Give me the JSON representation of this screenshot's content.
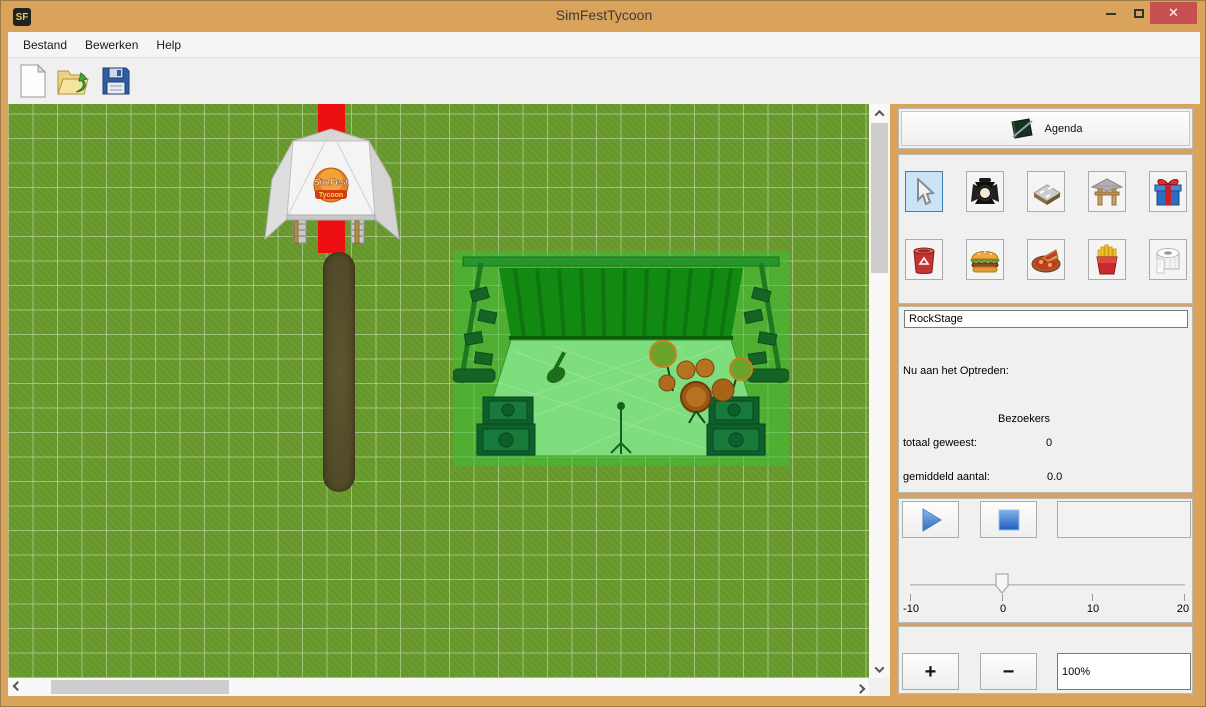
{
  "window": {
    "logo_text": "SF",
    "title": "SimFestTycoon",
    "close_glyph": "✕"
  },
  "menu": {
    "bestand": "Bestand",
    "bewerken": "Bewerken",
    "help": "Help"
  },
  "toolbar": {
    "buttons": [
      "new-file-icon",
      "open-folder-icon",
      "save-floppy-icon"
    ]
  },
  "map": {
    "objects": [
      "entrance-tent",
      "red-carpet",
      "dirt-path",
      "rock-stage-preview"
    ]
  },
  "panel": {
    "agenda_label": "Agenda",
    "tools": [
      {
        "name": "select-tool",
        "icon": "cursor-arrow-icon",
        "selected": true
      },
      {
        "name": "spotlight-tool",
        "icon": "spotlight-icon",
        "selected": false
      },
      {
        "name": "road-tool",
        "icon": "road-tile-icon",
        "selected": false
      },
      {
        "name": "gate-tool",
        "icon": "entrance-gate-icon",
        "selected": false
      },
      {
        "name": "present-tool",
        "icon": "gift-box-icon",
        "selected": false
      },
      {
        "name": "trash-tool",
        "icon": "trash-can-icon",
        "selected": false
      },
      {
        "name": "burger-tool",
        "icon": "burger-icon",
        "selected": false
      },
      {
        "name": "pizza-tool",
        "icon": "pizza-icon",
        "selected": false
      },
      {
        "name": "fries-tool",
        "icon": "fries-icon",
        "selected": false
      },
      {
        "name": "toilet-paper-tool",
        "icon": "toilet-paper-icon",
        "selected": false
      }
    ],
    "stage_name": "RockStage",
    "now_performing_label": "Nu aan het Optreden:",
    "visitors_header": "Bezoekers",
    "total_label": "totaal geweest:",
    "total_value": "0",
    "average_label": "gemiddeld aantal:",
    "average_value": "0.0",
    "slider": {
      "labels": [
        "-10",
        "0",
        "10",
        "20"
      ],
      "value": 0
    },
    "zoom_plus": "+",
    "zoom_minus": "−",
    "zoom_level": "100%"
  },
  "colors": {
    "titlebar": "#D9A35C",
    "close_red": "#C75050",
    "grass": "#6B9C2F",
    "selected_tool_bg": "#CBE3F7",
    "carpet_red": "#EE1010"
  }
}
